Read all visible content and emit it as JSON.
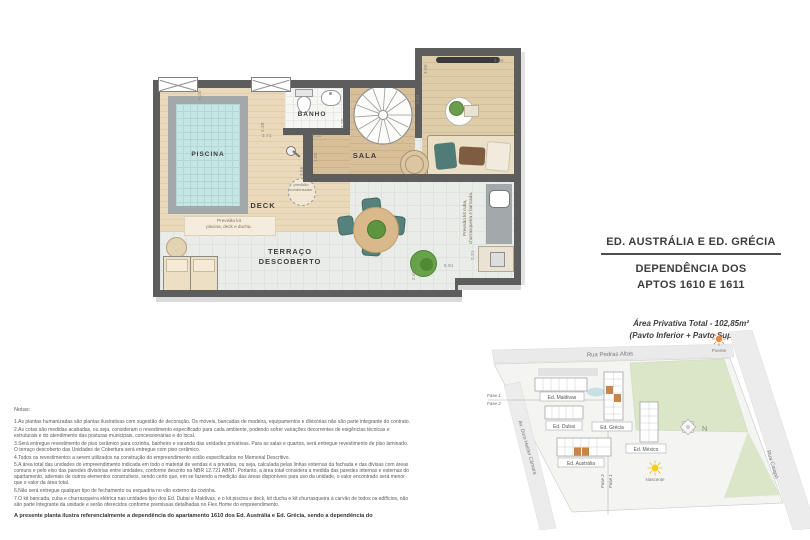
{
  "title_block": {
    "line1": "ED. AUSTRÁLIA E ED. GRÉCIA",
    "line2": "DEPENDÊNCIA DOS",
    "line3": "APTOS 1610 E 1611",
    "area": "Área Privativa Total - 102,85m²",
    "pavtos": "(Pavto Inferior + Pavto Superior)"
  },
  "floorplan": {
    "rooms": {
      "piscina": "PISCINA",
      "banho": "BANHO",
      "sala": "SALA",
      "deck": "DECK",
      "terraco": "TERRAÇO\nDESCOBERTO"
    },
    "annotations": {
      "kit_piscina": "Previsão kit\npiscina, deck e ducha.",
      "kit_cuba": "Previsão kit cuba,\nchurrasqueira e bancada.",
      "condensador": "previsão\ncondensador"
    },
    "dimensions": [
      "6.20",
      "2.30",
      "3.71",
      "5.10",
      "1.20",
      "1.05",
      "3.86",
      "2.43",
      "3.00",
      "2.30",
      "2.31",
      "6.91",
      "2.66"
    ]
  },
  "siteplan": {
    "streets": {
      "top": "Rua Pedras Altas",
      "left": "Av. Dom Helder Câmara",
      "right": "Rua Caiapó"
    },
    "buildings": [
      "Ed. Maldivas",
      "Ed. Dubai",
      "Ed. Grécia",
      "Ed. México",
      "Ed. Austrália"
    ],
    "compass": "N",
    "sun_west": "Poente",
    "sun_east": "Nascente",
    "phases": {
      "left_top": "Fase 1",
      "left_bottom": "Fase 2",
      "bottom_a": "Fase 2",
      "bottom_b": "Fase 1"
    },
    "highlight_color": "#c8854a"
  },
  "notes": {
    "heading": "Notas:",
    "items": [
      "1.As plantas humanizadas são plantas ilustrativas com sugestão de decoração. Os móveis, bancadas de madeira, equipamentos e divisórias não são parte integrante do contrato.",
      "2.As cotas são medidas acabadas, ou seja, consideram o revestimento especificado para cada ambiente, podendo sofrer variações decorrentes de exigências técnicas e estruturais e do atendimento das posturas municipais, concessionárias e do local.",
      "3.Será entregue revestimento de piso cerâmico para cozinha, banheiro e varanda das unidades privativas. Para as salas e quartos, será entregue revestimento de piso laminado. O terraço descoberto das Unidades de Cobertura será entregue com piso cerâmico.",
      "4.Todos os revestimentos a serem utilizados na construção do empreendimento estão especificados no Memorial Descritivo.",
      "5.A área total das unidades do empreendimento indicada em todo o material de vendas é a privativa, ou seja, calculada pelas linhas externas da fachada e das divisas com áreas comuns e pelo eixo das paredes divisórias entre unidades, conforme descrito na NBR 12.721 ABNT. Portanto, a área total considera a medida das paredes internas e externas do apartamento, ademais de outros elementos construtivos, sendo certo que, em se fazendo a medição das áreas disponíveis para uso da unidade, o valor encontrado será menor que o valor da área total.",
      "6.Não será entregue qualquer tipo de fechamento ou esquadria no vão externo da cozinha.",
      "7.O kit bancada, cuba e churrasqueira elétrica nas unidades tipo dos Ed. Dubai e Maldivas, e o kit piscina e deck, kit ducha e kit churrasqueira à carvão de todos os edifícios, não são parte integrante da unidade e serão oferecidos conforme premissas detalhadas no Flex Home do empreendimento."
    ],
    "footer": "A presente planta ilustra referencialmente a dependência do apartamento 1610 dos Ed. Austrália e Ed. Grécia, sendo a dependência do"
  }
}
